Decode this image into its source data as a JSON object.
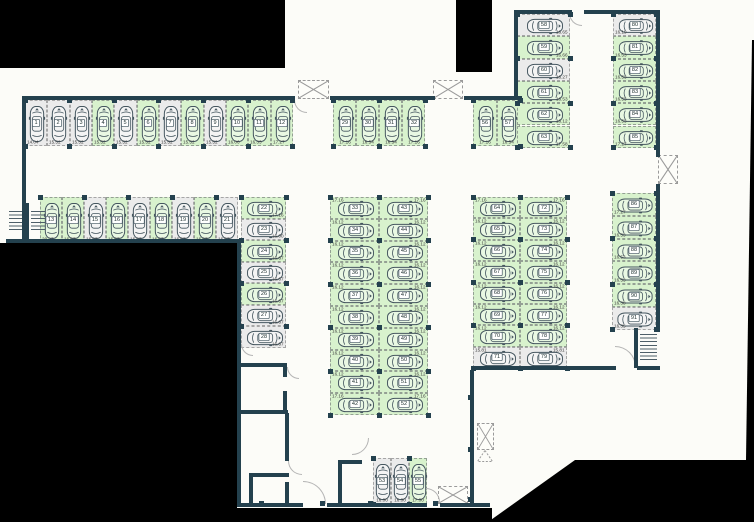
{
  "plan": {
    "title": "parking-level-floor-plan",
    "colors": {
      "wall": "#24414e",
      "available": "#d8f2cd",
      "occupied": "#ebebeb",
      "background": "#000000",
      "paper": "#fcfcf8"
    }
  },
  "stall_groups": [
    {
      "id": "row-top-left",
      "type": "row",
      "x": 25,
      "y": 100,
      "cw": 22.33,
      "h": 46,
      "car": "v",
      "lp": "bl",
      "stalls": [
        {
          "n": 1,
          "m": "14.04",
          "c": "gray"
        },
        {
          "n": 2,
          "m": "15.52",
          "c": "gray"
        },
        {
          "n": 3,
          "m": "15.52",
          "c": "gray"
        },
        {
          "n": 4,
          "m": "15.52",
          "c": "green"
        },
        {
          "n": 5,
          "m": "15.52",
          "c": "gray"
        },
        {
          "n": 6,
          "m": "15.52",
          "c": "green"
        },
        {
          "n": 7,
          "m": "15.52",
          "c": "gray"
        },
        {
          "n": 8,
          "m": "15.52",
          "c": "green"
        },
        {
          "n": 9,
          "m": "15.52",
          "c": "gray"
        },
        {
          "n": 10,
          "m": "16.06",
          "c": "green"
        },
        {
          "n": 11,
          "m": "16.33",
          "c": "green"
        },
        {
          "n": 12,
          "m": "17.27",
          "c": "green"
        }
      ]
    },
    {
      "id": "row-second",
      "type": "row",
      "x": 40,
      "y": 197,
      "cw": 22,
      "h": 46,
      "car": "v",
      "lp": "bl",
      "stalls": [
        {
          "n": 13,
          "m": "20.27",
          "c": "green"
        },
        {
          "n": 14,
          "m": "16.67",
          "c": "green"
        },
        {
          "n": 15,
          "m": "16.67",
          "c": "gray"
        },
        {
          "n": 16,
          "m": "16.67",
          "c": "green"
        },
        {
          "n": 17,
          "m": "16.67",
          "c": "gray"
        },
        {
          "n": 18,
          "m": "16.67",
          "c": "green"
        },
        {
          "n": 19,
          "m": "16.67",
          "c": "gray"
        },
        {
          "n": 20,
          "m": "16.67",
          "c": "green"
        },
        {
          "n": 21,
          "m": "16.67",
          "c": "gray"
        }
      ]
    },
    {
      "id": "col-left-stack",
      "type": "col",
      "x": 241,
      "y": 197,
      "w": 45,
      "ch": 21.5,
      "car": "h",
      "lp": "br",
      "stalls": [
        {
          "n": 22,
          "m": "17.16",
          "c": "green"
        },
        {
          "n": 23,
          "m": "16.00",
          "c": "gray"
        },
        {
          "n": 24,
          "m": "16.67",
          "c": "green"
        },
        {
          "n": 25,
          "m": "16.67",
          "c": "gray"
        },
        {
          "n": 26,
          "m": "16.67",
          "c": "green"
        },
        {
          "n": 27,
          "m": "16.67",
          "c": "gray"
        },
        {
          "n": 28,
          "m": "16.67",
          "c": "gray"
        }
      ]
    },
    {
      "id": "row-top-middle",
      "type": "row",
      "x": 333,
      "y": 100,
      "cw": 23,
      "h": 46,
      "car": "v",
      "lp": "b",
      "stalls": [
        {
          "n": 29,
          "m": "17.16",
          "c": "green"
        },
        {
          "n": 30,
          "m": "16.54",
          "c": "green"
        },
        {
          "n": 31,
          "m": "16.54",
          "c": "green"
        },
        {
          "n": 32,
          "m": "17.16",
          "c": "green"
        }
      ]
    },
    {
      "id": "block-mid-left",
      "type": "col",
      "x": 330,
      "y": 197,
      "w": 49,
      "ch": 21.8,
      "car": "h",
      "lp": "tl",
      "stalls": [
        {
          "n": 33,
          "m": "17.16",
          "c": "green"
        },
        {
          "n": 34,
          "m": "16.12",
          "c": "green"
        },
        {
          "n": 35,
          "m": "16.12",
          "c": "green"
        },
        {
          "n": 36,
          "m": "16.12",
          "c": "green"
        },
        {
          "n": 37,
          "m": "16.12",
          "c": "green"
        },
        {
          "n": 38,
          "m": "16.12",
          "c": "green"
        },
        {
          "n": 39,
          "m": "16.12",
          "c": "green"
        },
        {
          "n": 40,
          "m": "16.12",
          "c": "green"
        },
        {
          "n": 41,
          "m": "16.12",
          "c": "green"
        },
        {
          "n": 42,
          "m": "17.16",
          "c": "green"
        }
      ]
    },
    {
      "id": "block-mid-right",
      "type": "col",
      "x": 379,
      "y": 197,
      "w": 49,
      "ch": 21.8,
      "car": "h",
      "lp": "tr",
      "stalls": [
        {
          "n": 43,
          "m": "17.16",
          "c": "green"
        },
        {
          "n": 44,
          "m": "16.12",
          "c": "green"
        },
        {
          "n": 45,
          "m": "16.12",
          "c": "green"
        },
        {
          "n": 46,
          "m": "16.12",
          "c": "green"
        },
        {
          "n": 47,
          "m": "16.12",
          "c": "green"
        },
        {
          "n": 48,
          "m": "16.12",
          "c": "green"
        },
        {
          "n": 49,
          "m": "16.12",
          "c": "green"
        },
        {
          "n": 50,
          "m": "16.12",
          "c": "green"
        },
        {
          "n": 51,
          "m": "16.12",
          "c": "green"
        },
        {
          "n": 52,
          "m": "17.16",
          "c": "green"
        }
      ]
    },
    {
      "id": "row-bottom-center",
      "type": "row",
      "x": 373,
      "y": 458,
      "cw": 18,
      "h": 46,
      "car": "v",
      "lp": "b",
      "stalls": [
        {
          "n": 53,
          "m": "16.00",
          "c": "gray"
        },
        {
          "n": 54,
          "m": "16.00",
          "c": "gray"
        },
        {
          "n": 55,
          "m": "17.00",
          "c": "green"
        }
      ]
    },
    {
      "id": "row-top-right-pair",
      "type": "row",
      "x": 473,
      "y": 100,
      "cw": 23.5,
      "h": 46,
      "car": "v",
      "lp": "b",
      "stalls": [
        {
          "n": 56,
          "m": "17.16",
          "c": "green"
        },
        {
          "n": 57,
          "m": "16.54",
          "c": "green"
        }
      ]
    },
    {
      "id": "block-right-left",
      "type": "col",
      "x": 473,
      "y": 197,
      "w": 47,
      "ch": 21.4,
      "car": "h",
      "lp": "tl",
      "stalls": [
        {
          "n": 64,
          "m": "17.16",
          "c": "green"
        },
        {
          "n": 65,
          "m": "16.12",
          "c": "green"
        },
        {
          "n": 66,
          "m": "16.12",
          "c": "green"
        },
        {
          "n": 67,
          "m": "16.12",
          "c": "green"
        },
        {
          "n": 68,
          "m": "16.12",
          "c": "green"
        },
        {
          "n": 69,
          "m": "16.12",
          "c": "green"
        },
        {
          "n": 70,
          "m": "16.12",
          "c": "green"
        },
        {
          "n": 71,
          "m": "15.81",
          "c": "gray"
        }
      ]
    },
    {
      "id": "block-right-right",
      "type": "col",
      "x": 520,
      "y": 197,
      "w": 47,
      "ch": 21.4,
      "car": "h",
      "lp": "tr",
      "stalls": [
        {
          "n": 72,
          "m": "17.16",
          "c": "green"
        },
        {
          "n": 73,
          "m": "16.12",
          "c": "green"
        },
        {
          "n": 74,
          "m": "16.12",
          "c": "green"
        },
        {
          "n": 75,
          "m": "16.12",
          "c": "green"
        },
        {
          "n": 76,
          "m": "16.12",
          "c": "green"
        },
        {
          "n": 77,
          "m": "16.12",
          "c": "green"
        },
        {
          "n": 78,
          "m": "16.12",
          "c": "green"
        },
        {
          "n": 79,
          "m": "15.81",
          "c": "gray"
        }
      ]
    },
    {
      "id": "col-topright-inner",
      "type": "col",
      "x": 517,
      "y": 14,
      "w": 53,
      "ch": 22.3,
      "car": "h",
      "lp": "br",
      "stalls": [
        {
          "n": 58,
          "m": "16.65",
          "c": "gray"
        },
        {
          "n": 59,
          "m": "16.66",
          "c": "green"
        },
        {
          "n": 60,
          "m": "16.27",
          "c": "gray"
        },
        {
          "n": 61,
          "m": "16.53",
          "c": "green"
        },
        {
          "n": 62,
          "m": "16.12",
          "c": "green"
        },
        {
          "n": 63,
          "m": "17.58",
          "c": "green"
        }
      ]
    },
    {
      "id": "col-topright-outer",
      "type": "col",
      "x": 613,
      "y": 14,
      "w": 43,
      "ch": 22.3,
      "car": "h",
      "lp": "bl",
      "stalls": [
        {
          "n": 80,
          "m": "16.19",
          "c": "gray"
        },
        {
          "n": 81,
          "m": "16.53",
          "c": "green"
        },
        {
          "n": 82,
          "m": "16.53",
          "c": "green"
        },
        {
          "n": 83,
          "m": "16.53",
          "c": "green"
        },
        {
          "n": 84,
          "m": "16.53",
          "c": "green"
        },
        {
          "n": 85,
          "m": "17.27",
          "c": "green"
        }
      ]
    },
    {
      "id": "col-far-right",
      "type": "col",
      "x": 612,
      "y": 193,
      "w": 44,
      "ch": 22.8,
      "car": "h",
      "lp": "bl",
      "stalls": [
        {
          "n": 86,
          "m": "17.27",
          "c": "green"
        },
        {
          "n": 87,
          "m": "16.53",
          "c": "green"
        },
        {
          "n": 88,
          "m": "16.53",
          "c": "green"
        },
        {
          "n": 89,
          "m": "16.53",
          "c": "green"
        },
        {
          "n": 90,
          "m": "16.38",
          "c": "green"
        },
        {
          "n": 91,
          "m": "16.35",
          "c": "gray"
        }
      ]
    }
  ],
  "layout": {
    "walls": [
      [
        22,
        96,
        273,
        4
      ],
      [
        22,
        96,
        4,
        147
      ],
      [
        6,
        239,
        233,
        4
      ],
      [
        26,
        203,
        3,
        38
      ],
      [
        237,
        239,
        4,
        268
      ],
      [
        330,
        96,
        105,
        4
      ],
      [
        464,
        96,
        58,
        4
      ],
      [
        514,
        10,
        58,
        4
      ],
      [
        584,
        10,
        76,
        4
      ],
      [
        514,
        10,
        4,
        90
      ],
      [
        656,
        10,
        4,
        147
      ],
      [
        656,
        184,
        4,
        148
      ],
      [
        634,
        328,
        4,
        40
      ],
      [
        473,
        366,
        143,
        4
      ],
      [
        637,
        366,
        23,
        4
      ],
      [
        470,
        370,
        4,
        137
      ],
      [
        237,
        503,
        66,
        4
      ],
      [
        327,
        503,
        46,
        4
      ],
      [
        373,
        503,
        54,
        4
      ],
      [
        440,
        503,
        50,
        4
      ],
      [
        240,
        363,
        46,
        4
      ],
      [
        283,
        363,
        4,
        14
      ],
      [
        283,
        391,
        4,
        22
      ],
      [
        240,
        410,
        48,
        4
      ],
      [
        285,
        413,
        4,
        48
      ],
      [
        285,
        482,
        4,
        23
      ],
      [
        249,
        473,
        40,
        4
      ],
      [
        249,
        473,
        4,
        32
      ],
      [
        338,
        460,
        4,
        45
      ],
      [
        338,
        460,
        24,
        4
      ]
    ],
    "blacks": [
      {
        "x": 0,
        "y": 0,
        "w": 285,
        "h": 68
      },
      {
        "x": 456,
        "y": 0,
        "w": 36,
        "h": 72
      },
      {
        "x": 0,
        "y": 243,
        "w": 237,
        "h": 279
      },
      {
        "x": 237,
        "y": 508,
        "w": 255,
        "h": 14
      }
    ],
    "wedge": {
      "x": 480,
      "y": 455,
      "w": 274,
      "h": 67,
      "poly": "8px 67px,95px 5px,274px 5px,274px 67px"
    },
    "sliver": {
      "x": 744,
      "y": 40,
      "w": 10,
      "h": 420,
      "poly": "8px 0,10px 0,10px 420px,2px 420px"
    },
    "xboxes": [
      [
        298,
        80,
        31,
        19
      ],
      [
        433,
        80,
        30,
        19
      ],
      [
        658,
        155,
        20,
        29
      ],
      [
        477,
        423,
        17,
        27
      ],
      [
        438,
        486,
        30,
        18
      ]
    ],
    "triangle": [
      477,
      450,
      16,
      12
    ],
    "doors": [
      [
        294,
        100,
        13,
        0
      ],
      [
        569,
        13,
        13,
        0
      ],
      [
        241,
        344,
        12,
        0
      ],
      [
        287,
        367,
        12,
        0
      ],
      [
        288,
        461,
        14,
        0
      ],
      [
        303,
        481,
        23,
        180
      ],
      [
        352,
        438,
        17,
        270
      ],
      [
        426,
        488,
        14,
        180
      ],
      [
        615,
        346,
        21,
        180
      ]
    ],
    "stairs": [
      [
        9,
        211,
        14,
        21
      ],
      [
        31,
        211,
        14,
        21
      ],
      [
        640,
        334,
        17,
        28
      ]
    ],
    "markers": [
      [
        236,
        360
      ],
      [
        236,
        407
      ],
      [
        236,
        458
      ],
      [
        468,
        395
      ],
      [
        468,
        447
      ],
      [
        468,
        497
      ],
      [
        320,
        501
      ],
      [
        368,
        501
      ],
      [
        433,
        501
      ],
      [
        259,
        501
      ]
    ]
  }
}
